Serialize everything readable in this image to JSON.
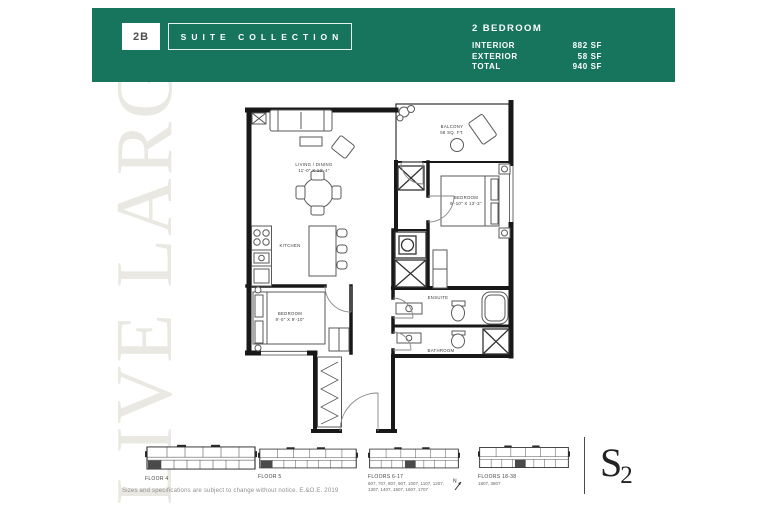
{
  "header": {
    "accent_color": "#17755e",
    "unit_code": "2B",
    "collection": "SUITE COLLECTION",
    "plan_type": "2 BEDROOM",
    "stats": [
      {
        "label": "INTERIOR",
        "value": "882 SF"
      },
      {
        "label": "EXTERIOR",
        "value": "58 SF"
      },
      {
        "label": "TOTAL",
        "value": "940 SF"
      }
    ]
  },
  "watermark": "LIVE LARGE",
  "floorplan": {
    "living_dining": {
      "name": "LIVING / DINING",
      "dims": "11'-0\" X 13'-4\""
    },
    "balcony": {
      "name": "BALCONY",
      "dims": "58 SQ. FT."
    },
    "bedroom": {
      "name": "BEDROOM",
      "dims": "9'-10\" X 13'-2\""
    },
    "kitchen": {
      "name": "KITCHEN"
    },
    "bedroom2": {
      "name": "BEDROOM",
      "dims": "9'-0\" X 9'-10\""
    },
    "ensuite": {
      "name": "ENSUITE"
    },
    "bathroom": {
      "name": "BATHROOM"
    }
  },
  "keyplans": [
    {
      "label": "FLOOR 4",
      "suites": ""
    },
    {
      "label": "FLOOR 5",
      "suites": ""
    },
    {
      "label": "FLOORS 6-17",
      "suites": "607, 707, 807, 907, 1007, 1107, 1207, 1307, 1407, 1507, 1607, 1707"
    },
    {
      "label": "FLOORS 18-38",
      "suites": "1807, 3807"
    }
  ],
  "compass": "N",
  "logo": {
    "main": "S",
    "sub": "2"
  },
  "disclaimer": "Sizes and specifications are subject to change without notice. E.&O.E. 2019"
}
